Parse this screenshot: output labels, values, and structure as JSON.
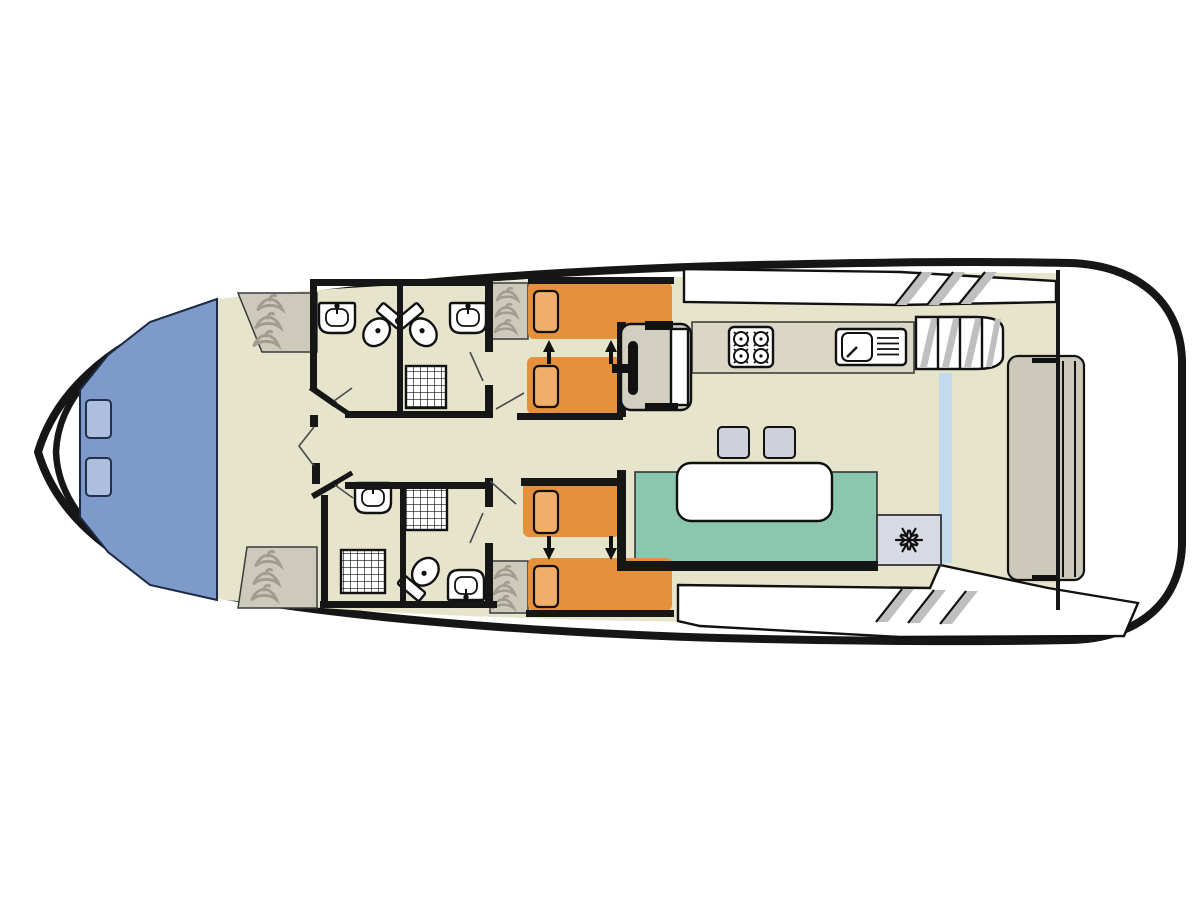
{
  "diagram": {
    "type": "boat-floor-plan",
    "view": "top-down deck plan of a canal cruiser / houseboat",
    "sections": [
      "bow-deck",
      "front-cabin",
      "four-bathrooms",
      "port-twin-cabin",
      "starboard-twin-cabin",
      "central-corridor",
      "helm-station",
      "galley",
      "saloon-dinette",
      "side-walkways",
      "stern-deck"
    ],
    "furniture_counts": {
      "beds": 4,
      "pillows": 4,
      "toilets": 3,
      "bathroom_sinks": 4,
      "kitchen_sinks": 1,
      "showers": 3,
      "wardrobes": 4,
      "stools": 2,
      "bow_hatches": 2,
      "stove_burners": 4,
      "sliding_doors": 1,
      "staircases": 3
    }
  },
  "icons": {
    "hanger": "wardrobe-hanger-squiggle",
    "snowflake": "fridge-snowflake-6-spoke",
    "burner": "stove-burner-ring",
    "shower": "grid-tray",
    "steps": "diagonal-tread-marks",
    "arrow": "bed-slide-arrow"
  },
  "palette": {
    "hull_line": "#161616",
    "deck": "#ffffff",
    "floor": "#e7e4cc",
    "bow_deck": "#7e9aca",
    "hatch": "#adbede",
    "hatch_line": "#22304c",
    "bed": "#e5913c",
    "pillow": "#f1ae6a",
    "sofa": "#8bc7ae",
    "table": "#ffffff",
    "stool": "#ced1da",
    "fridge": "#d7dae2",
    "counter": "#dad7c6",
    "wardrobe": "#cdcabc",
    "hanger": "#a19d8e",
    "door_panel": "#ccc9ba",
    "glass": "#c2daee",
    "step_shade": "#bfbfbf",
    "console": "#d2cfc0",
    "ink": "#111111"
  }
}
